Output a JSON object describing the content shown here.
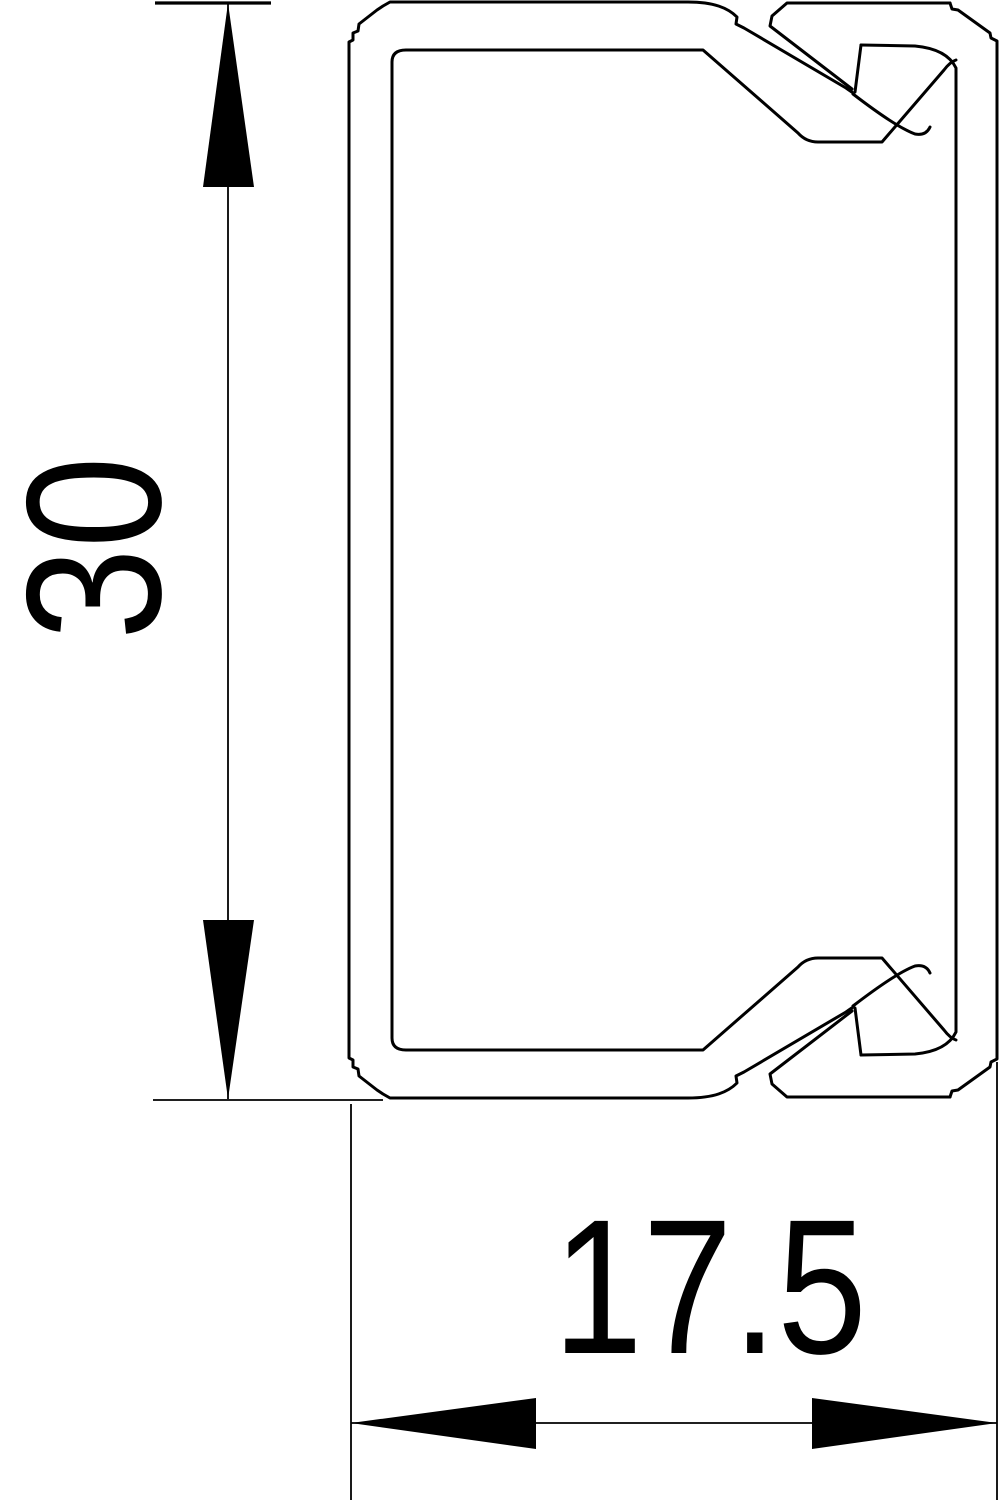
{
  "drawing": {
    "type": "technical-cross-section",
    "subject": "cable trunking profile with snap-on lid",
    "background_color": "#ffffff",
    "line_color": "#000000"
  },
  "dimensions": {
    "height": {
      "label": "30",
      "orientation": "vertical"
    },
    "width": {
      "label": "17.5",
      "orientation": "horizontal"
    }
  }
}
